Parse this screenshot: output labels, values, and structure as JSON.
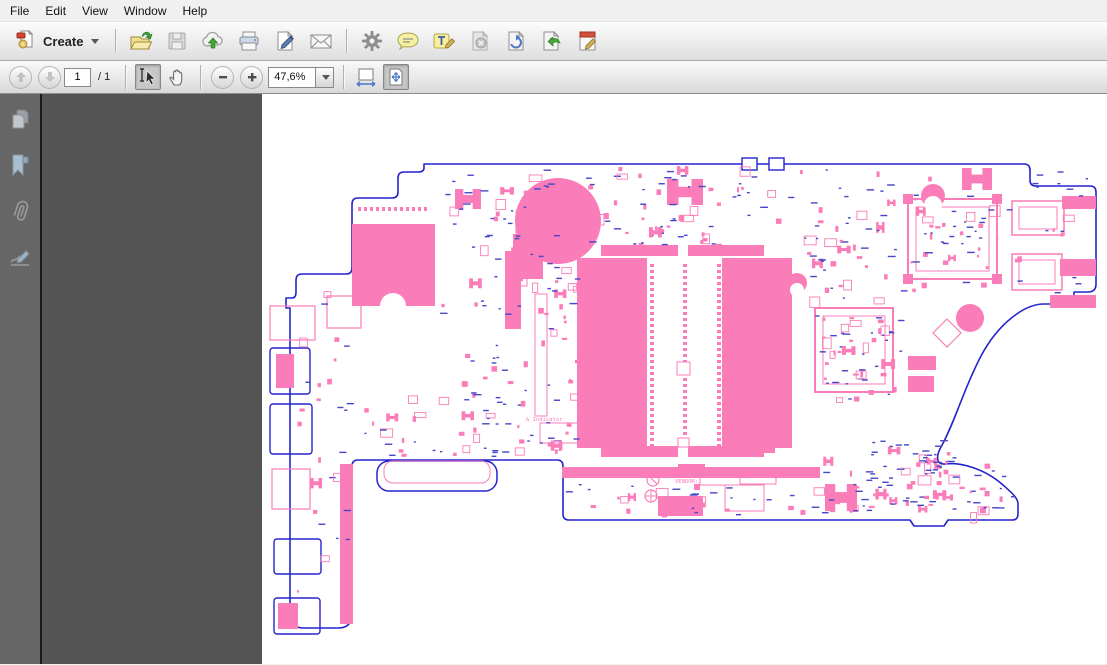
{
  "menu_bar": {
    "items": [
      "File",
      "Edit",
      "View",
      "Window",
      "Help"
    ]
  },
  "toolbar": {
    "create_button": {
      "label": "Create"
    },
    "file_icons": [
      "open",
      "save",
      "cloud-upload",
      "print",
      "fill-sign",
      "email"
    ],
    "tool_icons": [
      "preferences-gear",
      "comment-bubble",
      "highlight-text",
      "delete-page",
      "rotate-page",
      "export-page",
      "edit-document"
    ]
  },
  "nav_toolbar": {
    "page_number": "1",
    "page_total": "/ 1",
    "zoom_value": "47,6%",
    "icons": [
      "previous-page",
      "next-page",
      "select-tool",
      "hand-tool",
      "zoom-out",
      "zoom-in",
      "fit-width",
      "fit-page"
    ]
  },
  "nav_panel": {
    "icons": [
      "page-thumbnails",
      "bookmarks",
      "attachments",
      "signatures"
    ]
  },
  "colors": {
    "pink": "#fa7cb8",
    "blue": "#2424cd",
    "tblue": "#4646c8",
    "white": "#ffffff",
    "doc_bg": "#545454",
    "sidebar_bg": "#666666",
    "page_bg": "#ffffff"
  },
  "pcb": {
    "outline": "M162,70 L762,70 Q768,70 768,76 L768,86 Q768,92 774,92 L828,92 Q834,92 834,98 L834,190 Q834,198 826,198 L812,198 L812,206 Q812,210 806,210 L782,210 C762,210 736,230 719,262 C702,294 693,328 679,353 C673,364 675,371 684,370 C697,368 722,374 741,391 C750,399 756,404 756,410 L756,420 Q756,426 750,426 L686,426 L682,432 L652,432 L648,426 L307,426 Q301,426 301,420 L301,372 Q301,366 295,366 L96,366 Q90,366 90,372 L90,520 Q90,534 76,534 L42,534 Q28,534 28,520 L28,214 L24,214 L24,204 L30,204 Q34,204 34,198 L34,186 Q34,180 40,180 L84,180 Q90,180 90,174 L90,110 Q90,104 96,104 L130,104 Q136,104 136,98 L136,84 Q136,78 142,78 L156,78 Q162,78 162,74 Z",
    "labels": [
      {
        "text": "RTC",
        "x": 301,
        "y": 140,
        "size": 7,
        "c": "pink"
      },
      {
        "text": "& Indicator",
        "x": 264,
        "y": 327,
        "size": 5.5,
        "c": "pink"
      },
      {
        "text": "VENDOR:",
        "x": 413,
        "y": 389,
        "size": 5.5,
        "c": "pink"
      }
    ],
    "shapes": [
      {
        "t": "rect",
        "x": 8,
        "y": 212,
        "w": 45,
        "h": 34,
        "s": "pink",
        "sw": 1.2
      },
      {
        "t": "rect",
        "x": 8,
        "y": 254,
        "w": 40,
        "h": 46,
        "s": "blue",
        "sw": 1.4,
        "rx": 3
      },
      {
        "t": "rect",
        "x": 14,
        "y": 260,
        "w": 18,
        "h": 34,
        "f": "pink"
      },
      {
        "t": "rect",
        "x": 8,
        "y": 310,
        "w": 42,
        "h": 50,
        "s": "blue",
        "sw": 1.4,
        "rx": 3
      },
      {
        "t": "rect",
        "x": 10,
        "y": 375,
        "w": 38,
        "h": 40,
        "s": "pink",
        "sw": 1.2
      },
      {
        "t": "rect",
        "x": 12,
        "y": 445,
        "w": 47,
        "h": 35,
        "s": "blue",
        "sw": 1.4,
        "rx": 3
      },
      {
        "t": "rect",
        "x": 12,
        "y": 504,
        "w": 46,
        "h": 36,
        "s": "blue",
        "sw": 1.4,
        "rx": 3
      },
      {
        "t": "rect",
        "x": 16,
        "y": 509,
        "w": 20,
        "h": 26,
        "f": "pink"
      },
      {
        "t": "rect",
        "x": 90,
        "y": 130,
        "w": 83,
        "h": 82,
        "f": "pink"
      },
      {
        "t": "dots",
        "x": 96,
        "y": 113,
        "n": 12,
        "dx": 6,
        "w": 3,
        "h": 4,
        "f": "pink"
      },
      {
        "t": "circle",
        "cx": 131,
        "cy": 212,
        "r": 13,
        "f": "white"
      },
      {
        "t": "rect",
        "x": 65,
        "y": 202,
        "w": 34,
        "h": 32,
        "s": "pink",
        "sw": 1.2
      },
      {
        "t": "rect",
        "x": 78,
        "y": 370,
        "w": 13,
        "h": 160,
        "f": "pink"
      },
      {
        "t": "circle",
        "cx": 296,
        "cy": 127,
        "r": 43,
        "f": "pink"
      },
      {
        "t": "rect",
        "x": 243,
        "y": 157,
        "w": 16,
        "h": 78,
        "f": "pink"
      },
      {
        "t": "rect",
        "x": 251,
        "y": 140,
        "w": 30,
        "h": 45,
        "f": "pink"
      },
      {
        "t": "rect",
        "x": 254,
        "y": 117,
        "w": 11,
        "h": 75,
        "s": "pink",
        "sw": 1
      },
      {
        "t": "rect",
        "x": 273,
        "y": 200,
        "w": 12,
        "h": 122,
        "s": "pink",
        "sw": 1
      },
      {
        "t": "rect",
        "x": 339,
        "y": 151,
        "w": 77,
        "h": 11,
        "f": "pink"
      },
      {
        "t": "rect",
        "x": 426,
        "y": 151,
        "w": 76,
        "h": 11,
        "f": "pink"
      },
      {
        "t": "rect",
        "x": 315,
        "y": 164,
        "w": 70,
        "h": 190,
        "f": "pink"
      },
      {
        "t": "rect",
        "x": 460,
        "y": 164,
        "w": 70,
        "h": 190,
        "f": "pink"
      },
      {
        "t": "rect",
        "x": 339,
        "y": 352,
        "w": 77,
        "h": 11,
        "f": "pink"
      },
      {
        "t": "rect",
        "x": 426,
        "y": 352,
        "w": 76,
        "h": 11,
        "f": "pink"
      },
      {
        "t": "pincol",
        "x": 388,
        "y1": 170,
        "y2": 350,
        "step": 6,
        "w": 4,
        "h": 3,
        "f": "pink"
      },
      {
        "t": "pincol",
        "x": 421,
        "y1": 170,
        "y2": 350,
        "step": 6,
        "w": 4,
        "h": 3,
        "f": "pink"
      },
      {
        "t": "pincol",
        "x": 455,
        "y1": 170,
        "y2": 350,
        "step": 6,
        "w": 4,
        "h": 3,
        "f": "pink"
      },
      {
        "t": "rect",
        "x": 415,
        "y": 268,
        "w": 13,
        "h": 13,
        "f": "white",
        "s": "pink",
        "sw": 1
      },
      {
        "t": "rect",
        "x": 416,
        "y": 344,
        "w": 11,
        "h": 9,
        "f": "white",
        "s": "pink",
        "sw": 1
      },
      {
        "t": "rect",
        "x": 553,
        "y": 214,
        "w": 78,
        "h": 84,
        "s": "pink",
        "sw": 2
      },
      {
        "t": "rect",
        "x": 561,
        "y": 222,
        "w": 62,
        "h": 68,
        "s": "pink",
        "sw": 1
      },
      {
        "t": "rect",
        "x": 646,
        "y": 105,
        "w": 89,
        "h": 80,
        "s": "pink",
        "sw": 2
      },
      {
        "t": "rect",
        "x": 654,
        "y": 113,
        "w": 73,
        "h": 64,
        "s": "pink",
        "sw": 1
      },
      {
        "t": "rect",
        "x": 641,
        "y": 100,
        "w": 10,
        "h": 10,
        "f": "pink"
      },
      {
        "t": "rect",
        "x": 730,
        "y": 100,
        "w": 10,
        "h": 10,
        "f": "pink"
      },
      {
        "t": "rect",
        "x": 641,
        "y": 180,
        "w": 10,
        "h": 10,
        "f": "pink"
      },
      {
        "t": "rect",
        "x": 730,
        "y": 180,
        "w": 10,
        "h": 10,
        "f": "pink"
      },
      {
        "t": "rect",
        "x": 750,
        "y": 107,
        "w": 52,
        "h": 34,
        "s": "pink",
        "sw": 1.5
      },
      {
        "t": "rect",
        "x": 757,
        "y": 113,
        "w": 38,
        "h": 22,
        "s": "pink",
        "sw": 1
      },
      {
        "t": "rect",
        "x": 750,
        "y": 160,
        "w": 50,
        "h": 36,
        "s": "pink",
        "sw": 1.5
      },
      {
        "t": "rect",
        "x": 757,
        "y": 166,
        "w": 36,
        "h": 24,
        "s": "pink",
        "sw": 1
      },
      {
        "t": "rect",
        "x": 800,
        "y": 102,
        "w": 34,
        "h": 13,
        "f": "pink"
      },
      {
        "t": "rect",
        "x": 798,
        "y": 165,
        "w": 36,
        "h": 17,
        "f": "pink"
      },
      {
        "t": "rect",
        "x": 788,
        "y": 201,
        "w": 46,
        "h": 13,
        "f": "pink"
      },
      {
        "t": "circle",
        "cx": 708,
        "cy": 224,
        "r": 14,
        "f": "pink"
      },
      {
        "t": "path",
        "d": "M685,225L699,239L685,253L671,239Z",
        "s": "pink",
        "sw": 1.2
      },
      {
        "t": "circle",
        "cx": 671,
        "cy": 102,
        "r": 12,
        "f": "pink"
      },
      {
        "t": "circle",
        "cx": 671,
        "cy": 111,
        "r": 9,
        "f": "white"
      },
      {
        "t": "circle",
        "cx": 535,
        "cy": 189,
        "r": 10,
        "f": "pink"
      },
      {
        "t": "circle",
        "cx": 535,
        "cy": 196,
        "r": 7,
        "f": "white"
      },
      {
        "t": "h",
        "x": 193,
        "y": 95,
        "w": 26,
        "h": 20
      },
      {
        "t": "h",
        "x": 405,
        "y": 85,
        "w": 36,
        "h": 26
      },
      {
        "t": "h",
        "x": 700,
        "y": 74,
        "w": 30,
        "h": 22
      },
      {
        "t": "h",
        "x": 563,
        "y": 390,
        "w": 32,
        "h": 27
      },
      {
        "t": "h",
        "x": 345,
        "y": 222,
        "w": 22,
        "h": 26
      },
      {
        "t": "rect",
        "x": 115,
        "y": 367,
        "w": 120,
        "h": 30,
        "rx": 12,
        "s": "blue",
        "sw": 1.5
      },
      {
        "t": "rect",
        "x": 122,
        "y": 367,
        "w": 106,
        "h": 22,
        "rx": 9,
        "s": "pink",
        "sw": 1
      },
      {
        "t": "rect",
        "x": 300,
        "y": 373,
        "w": 258,
        "h": 11,
        "f": "pink"
      },
      {
        "t": "rect",
        "x": 416,
        "y": 370,
        "w": 27,
        "h": 14,
        "f": "pink"
      },
      {
        "t": "rect",
        "x": 438,
        "y": 381,
        "w": 40,
        "h": 10,
        "s": "pink",
        "sw": 1
      },
      {
        "t": "circle",
        "cx": 391,
        "cy": 386,
        "r": 6,
        "s": "pink",
        "sw": 1.2
      },
      {
        "t": "path",
        "d": "M387,382L395,390",
        "s": "pink",
        "sw": 1.2
      },
      {
        "t": "circle",
        "cx": 389,
        "cy": 402,
        "r": 6,
        "s": "pink",
        "sw": 1.2
      },
      {
        "t": "path",
        "d": "M383,402L395,402M389,396L389,408",
        "s": "pink",
        "sw": 1
      },
      {
        "t": "rect",
        "x": 396,
        "y": 402,
        "w": 45,
        "h": 20,
        "f": "pink"
      },
      {
        "t": "rect",
        "x": 463,
        "y": 391,
        "w": 39,
        "h": 26,
        "s": "pink",
        "sw": 1
      },
      {
        "t": "rect",
        "x": 478,
        "y": 381,
        "w": 36,
        "h": 9,
        "s": "pink",
        "sw": 1
      },
      {
        "t": "rect",
        "x": 278,
        "y": 329,
        "w": 47,
        "h": 20,
        "s": "pink",
        "sw": 1
      },
      {
        "t": "rect",
        "x": 495,
        "y": 329,
        "w": 18,
        "h": 30,
        "f": "pink"
      },
      {
        "t": "rect",
        "x": 646,
        "y": 262,
        "w": 28,
        "h": 14,
        "f": "pink"
      },
      {
        "t": "rect",
        "x": 646,
        "y": 282,
        "w": 26,
        "h": 16,
        "f": "pink"
      },
      {
        "t": "rect",
        "x": 480,
        "y": 64,
        "w": 15,
        "h": 12,
        "f": "white",
        "s": "blue",
        "sw": 1.4
      },
      {
        "t": "rect",
        "x": 507,
        "y": 64,
        "w": 15,
        "h": 12,
        "f": "white",
        "s": "blue",
        "sw": 1.4
      }
    ],
    "scatter": {
      "seed": 1337,
      "regions": [
        {
          "x": 178,
          "y": 74,
          "w": 120,
          "h": 156,
          "n": 60
        },
        {
          "x": 300,
          "y": 72,
          "w": 240,
          "h": 78,
          "n": 75
        },
        {
          "x": 540,
          "y": 72,
          "w": 100,
          "h": 138,
          "n": 50
        },
        {
          "x": 548,
          "y": 216,
          "w": 90,
          "h": 90,
          "n": 30
        },
        {
          "x": 280,
          "y": 160,
          "w": 34,
          "h": 200,
          "n": 22
        },
        {
          "x": 178,
          "y": 232,
          "w": 118,
          "h": 128,
          "n": 40
        },
        {
          "x": 96,
          "y": 300,
          "w": 200,
          "h": 62,
          "n": 32
        },
        {
          "x": 302,
          "y": 390,
          "w": 300,
          "h": 30,
          "n": 40
        },
        {
          "x": 560,
          "y": 358,
          "w": 180,
          "h": 60,
          "n": 45
        },
        {
          "x": 648,
          "y": 74,
          "w": 180,
          "h": 130,
          "n": 40
        },
        {
          "x": 598,
          "y": 345,
          "w": 86,
          "h": 72,
          "n": 50
        },
        {
          "x": 690,
          "y": 392,
          "w": 60,
          "h": 28,
          "n": 10
        },
        {
          "x": 32,
          "y": 185,
          "w": 55,
          "h": 330,
          "n": 28
        },
        {
          "x": 656,
          "y": 115,
          "w": 68,
          "h": 60,
          "n": 26
        },
        {
          "x": 560,
          "y": 222,
          "w": 62,
          "h": 66,
          "n": 22
        }
      ]
    }
  }
}
